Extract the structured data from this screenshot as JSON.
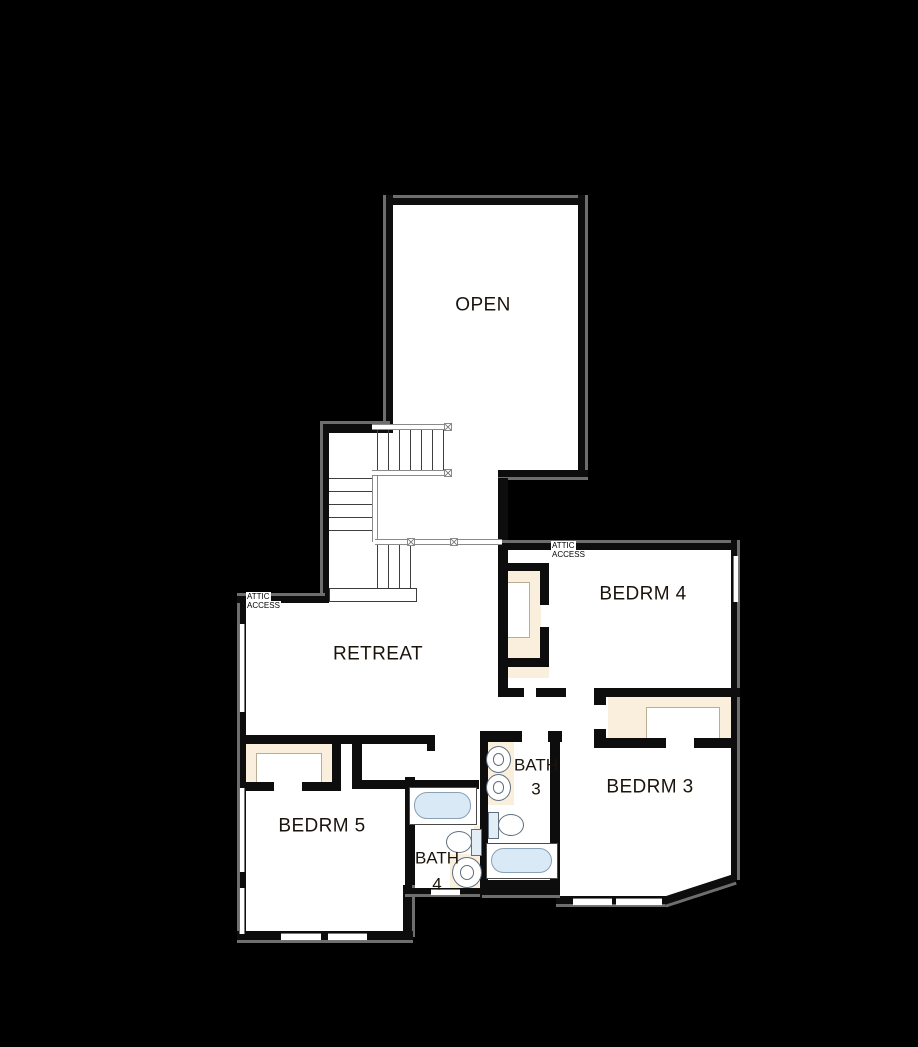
{
  "rooms": {
    "open": {
      "label": "OPEN"
    },
    "retreat": {
      "label": "RETREAT"
    },
    "bedrm4": {
      "label": "BEDRM 4"
    },
    "bedrm3": {
      "label": "BEDRM 3"
    },
    "bedrm5": {
      "label": "BEDRM 5"
    },
    "bath3": {
      "label_line1": "BATH",
      "label_line2": "3"
    },
    "bath4": {
      "label_line1": "BATH",
      "label_line2": "4"
    }
  },
  "annotations": {
    "attic_access_hall": {
      "line1": "ATTIC",
      "line2": "ACCESS"
    },
    "attic_access_retreat": {
      "line1": "ATTIC",
      "line2": "ACCESS"
    }
  },
  "colors": {
    "background": "#000000",
    "floor": "#ffffff",
    "wall": "#0d0d0d",
    "wall_bevel": "#6e6e6e",
    "closet_shelf": "#f9efdc",
    "shelf_line": "#b9ad92",
    "tub_fill": "#d9e9f5",
    "fixture_stroke": "#5f6f7e",
    "rail": "#8a8a8a",
    "text": "#1b140d"
  }
}
